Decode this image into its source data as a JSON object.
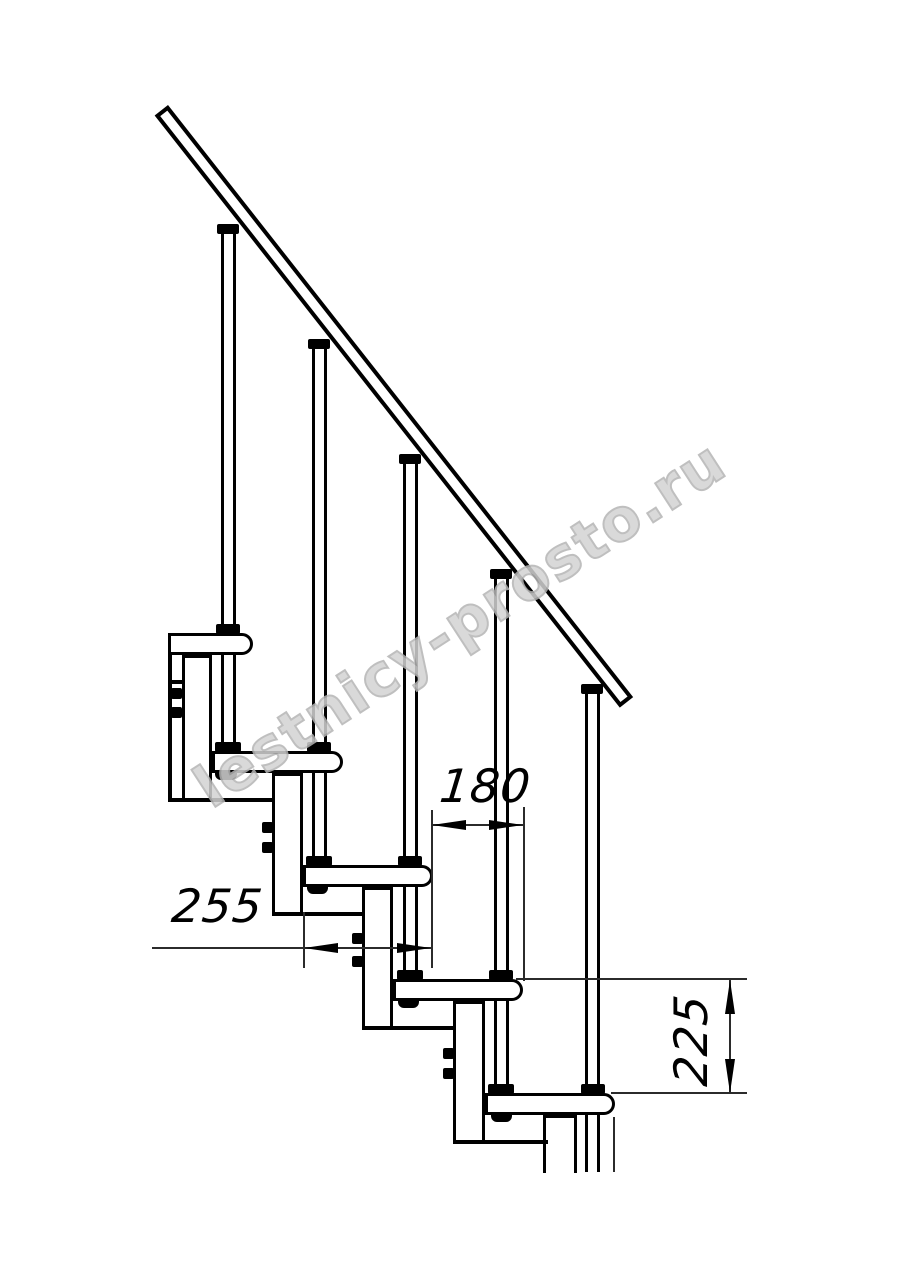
{
  "drawing": {
    "type": "staircase-side-view-technical-drawing",
    "dimensions": {
      "tread_depth": {
        "value": "255",
        "orientation": "horizontal"
      },
      "step_going": {
        "value": "180",
        "orientation": "horizontal"
      },
      "step_rise": {
        "value": "225",
        "orientation": "vertical-rotated"
      }
    },
    "watermark": {
      "text": "lestnicy-prosto.ru"
    },
    "colors": {
      "background": "#ffffff",
      "line": "#000000",
      "dimension_line": "#2b2b2b",
      "watermark_stroke": "#b5b5b5"
    },
    "parts": {
      "handrail": 1,
      "balusters": 5,
      "treads": 5,
      "support_columns": 5
    }
  }
}
